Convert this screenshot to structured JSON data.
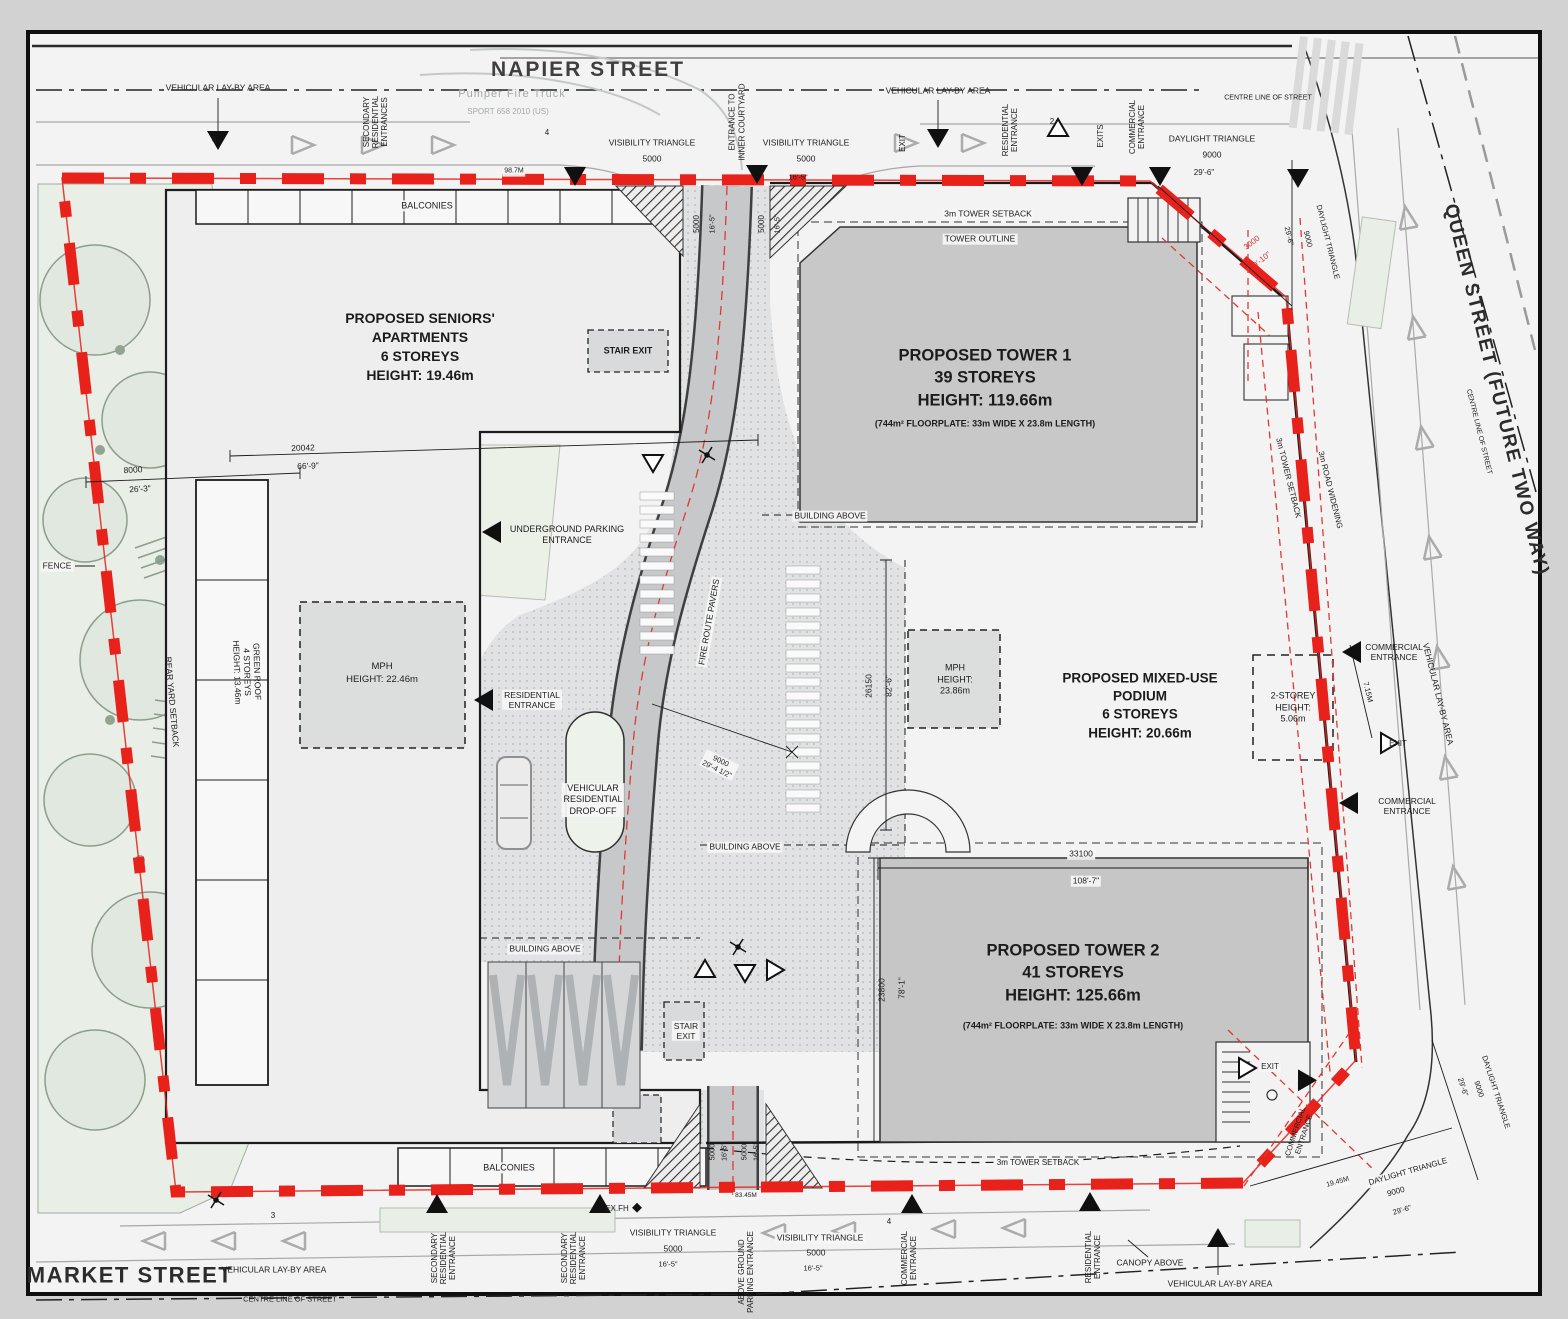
{
  "drawing_title": "Proposed mixed-use development site plan",
  "colors": {
    "boundary_red": "#e8211b",
    "tower_fill": "#c8c8c9",
    "green_area": "#e9efe6",
    "ground": "#f3f3f4",
    "line_black": "#1c1c1c"
  },
  "streets": {
    "top": "NAPIER STREET",
    "right": "QUEEN STREET (FUTURE TWO WAY)",
    "bottom": "MARKET STREET"
  },
  "annotations": [
    {
      "name": "street-label-napier",
      "t": "NAPIER STREET",
      "x": 588,
      "y": 70,
      "s": 21,
      "w": 700,
      "ls": 2,
      "c": "#3f3f3f"
    },
    {
      "name": "street-label-queen",
      "t": "QUEEN STREET (FUTURE TWO WAY)",
      "x": 1496,
      "y": 390,
      "s": 19,
      "w": 700,
      "ls": 1.5,
      "r": 76,
      "c": "#2c2c2c"
    },
    {
      "name": "street-label-market",
      "t": "MARKET STREET",
      "x": 130,
      "y": 1275,
      "s": 22,
      "w": 700,
      "ls": 1.5,
      "c": "#2c2c2c"
    },
    {
      "t": "CENTRE LINE OF STREET",
      "x": 290,
      "y": 1299,
      "s": 7.5
    },
    {
      "t": "CENTRE LINE OF STREET",
      "x": 1268,
      "y": 99,
      "s": 7
    },
    {
      "t": "CENTRE LINE OF STREET",
      "x": 1478,
      "y": 432,
      "s": 7,
      "r": 76
    },
    {
      "t": "VEHICULAR LAY-BY AREA",
      "x": 218,
      "y": 88,
      "s": 8.5
    },
    {
      "t": "SECONDARY\nRESIDENTIAL\nENTRANCES",
      "x": 376,
      "y": 122,
      "s": 8,
      "r": -90,
      "lh": 1.15
    },
    {
      "t": "Pumper Fire Truck",
      "x": 512,
      "y": 95,
      "s": 11,
      "c": "#a3aaa8",
      "ls": 1
    },
    {
      "t": "SPORT 658 2010 (US)",
      "x": 508,
      "y": 112,
      "s": 8,
      "c": "#a3aaa8"
    },
    {
      "t": "VISIBILITY TRIANGLE",
      "x": 652,
      "y": 143,
      "s": 8.5
    },
    {
      "t": "5000",
      "x": 652,
      "y": 159,
      "s": 8.5
    },
    {
      "t": "VISIBILITY TRIANGLE",
      "x": 806,
      "y": 143,
      "s": 8.5
    },
    {
      "t": "5000",
      "x": 806,
      "y": 159,
      "s": 8.5
    },
    {
      "t": "16'-5\"",
      "x": 798,
      "y": 177,
      "s": 7.5
    },
    {
      "t": "ENTRANCE TO\nINNER COURTYARD",
      "x": 737,
      "y": 122,
      "s": 8,
      "r": -90,
      "lh": 1.2
    },
    {
      "t": "VEHICULAR LAY-BY AREA",
      "x": 938,
      "y": 91,
      "s": 8.5
    },
    {
      "t": "EXIT",
      "x": 903,
      "y": 143,
      "s": 8,
      "r": -90
    },
    {
      "t": "RESIDENTIAL\nENTRANCE",
      "x": 1010,
      "y": 130,
      "s": 8,
      "r": -90,
      "lh": 1.15
    },
    {
      "t": "EXITS",
      "x": 1101,
      "y": 136,
      "s": 8,
      "r": -90
    },
    {
      "t": "COMMERCIAL\nENTRANCE",
      "x": 1137,
      "y": 127,
      "s": 8,
      "r": -90,
      "lh": 1.15
    },
    {
      "t": "DAYLIGHT TRIANGLE",
      "x": 1212,
      "y": 139,
      "s": 8.5
    },
    {
      "t": "9000",
      "x": 1212,
      "y": 155,
      "s": 8.5
    },
    {
      "t": "29'-6\"",
      "x": 1204,
      "y": 173,
      "s": 8
    },
    {
      "t": "3m TOWER SETBACK",
      "x": 988,
      "y": 214,
      "s": 8.5,
      "bg": 1
    },
    {
      "t": "TOWER OUTLINE",
      "x": 980,
      "y": 239,
      "s": 8.5,
      "bg": 1
    },
    {
      "t": "5000",
      "x": 697,
      "y": 224,
      "s": 8,
      "r": -90
    },
    {
      "t": "16'-5\"",
      "x": 712,
      "y": 224,
      "s": 7.5,
      "r": -90
    },
    {
      "t": "5000",
      "x": 762,
      "y": 224,
      "s": 8,
      "r": -90
    },
    {
      "t": "16'-5\"",
      "x": 777,
      "y": 224,
      "s": 7.5,
      "r": -90
    },
    {
      "t": "3000",
      "x": 1252,
      "y": 243,
      "s": 8,
      "r": -38,
      "c": "#d5352b"
    },
    {
      "t": "9'-10\"",
      "x": 1262,
      "y": 260,
      "s": 8,
      "r": -38,
      "c": "#d5352b"
    },
    {
      "t": "29'-6\"",
      "x": 1289,
      "y": 236,
      "s": 7.5,
      "r": 76
    },
    {
      "t": "9000",
      "x": 1308,
      "y": 239,
      "s": 7.5,
      "r": 76
    },
    {
      "t": "DAYLIGHT TRIANGLE",
      "x": 1328,
      "y": 242,
      "s": 7.5,
      "r": 76
    },
    {
      "t": "98.7M",
      "x": 514,
      "y": 172,
      "s": 7,
      "bg": 1
    },
    {
      "t": "6",
      "x": 214,
      "y": 140,
      "s": 8
    },
    {
      "t": "4",
      "x": 547,
      "y": 133,
      "s": 8
    },
    {
      "t": "2",
      "x": 1052,
      "y": 122,
      "s": 8
    },
    {
      "name": "label-seniors-apartments",
      "t": "PROPOSED SENIORS'\nAPARTMENTS\n6 STOREYS\nHEIGHT: 19.46m",
      "x": 420,
      "y": 347,
      "s": 14,
      "w": 600,
      "lh": 1.35
    },
    {
      "t": "STAIR EXIT",
      "x": 628,
      "y": 351,
      "s": 9,
      "w": 600
    },
    {
      "t": "20042",
      "x": 303,
      "y": 448,
      "s": 8.5,
      "r": -2
    },
    {
      "t": "66'-9\"",
      "x": 308,
      "y": 466,
      "s": 8.5,
      "r": -2
    },
    {
      "t": "8000",
      "x": 133,
      "y": 470,
      "s": 8.5,
      "r": -3
    },
    {
      "t": "26'-3\"",
      "x": 140,
      "y": 489,
      "s": 8.5,
      "r": -3
    },
    {
      "t": "FENCE",
      "x": 57,
      "y": 566,
      "s": 8.5,
      "bg": 1
    },
    {
      "t": "REAR YARD SETBACK",
      "x": 172,
      "y": 702,
      "s": 8.5,
      "r": 85
    },
    {
      "t": "GREEN ROOF\n4 STOREYS\nHEIGHT: 13.46m",
      "x": 247,
      "y": 672,
      "s": 8.5,
      "r": 88,
      "lh": 1.2
    },
    {
      "name": "label-mph-west",
      "t": "MPH\nHEIGHT: 22.46m",
      "x": 382,
      "y": 674,
      "s": 9.5,
      "lh": 1.35
    },
    {
      "t": "UNDERGROUND PARKING\nENTRANCE",
      "x": 567,
      "y": 535,
      "s": 9,
      "lh": 1.25
    },
    {
      "t": "RESIDENTIAL\nENTRANCE",
      "x": 532,
      "y": 700,
      "s": 8.5,
      "lh": 1.2,
      "bg": 1
    },
    {
      "t": "VEHICULAR\nRESIDENTIAL\nDROP-OFF",
      "x": 593,
      "y": 800,
      "s": 9,
      "lh": 1.25,
      "bg": 1
    },
    {
      "t": "FIRE ROUTE PAVERS",
      "x": 709,
      "y": 622,
      "s": 8.5,
      "r": -80,
      "bg": 1
    },
    {
      "t": "BUILDING ABOVE",
      "x": 830,
      "y": 516,
      "s": 8.5,
      "bg": 1
    },
    {
      "t": "BUILDING ABOVE",
      "x": 745,
      "y": 847,
      "s": 8.5,
      "bg": 1
    },
    {
      "t": "BUILDING ABOVE",
      "x": 545,
      "y": 949,
      "s": 8.5,
      "bg": 1
    },
    {
      "name": "label-tower-1",
      "t": "PROPOSED TOWER 1\n39 STOREYS\nHEIGHT: 119.66m",
      "x": 985,
      "y": 378,
      "s": 16.5,
      "w": 600,
      "lh": 1.35
    },
    {
      "name": "label-tower-1-floorplate",
      "t": "(744m² FLOORPLATE: 33m WIDE X 23.8m LENGTH)",
      "x": 985,
      "y": 424,
      "s": 9,
      "w": 700
    },
    {
      "name": "label-podium",
      "t": "PROPOSED MIXED-USE\nPODIUM\n6 STOREYS\nHEIGHT: 20.66m",
      "x": 1140,
      "y": 706,
      "s": 13.5,
      "w": 600,
      "lh": 1.35
    },
    {
      "name": "label-mph-east",
      "t": "MPH\nHEIGHT:\n23.86m",
      "x": 955,
      "y": 680,
      "s": 9,
      "lh": 1.3
    },
    {
      "t": "26150",
      "x": 869,
      "y": 686,
      "s": 8.5,
      "r": -90
    },
    {
      "t": "82'-6\"",
      "x": 889,
      "y": 686,
      "s": 8.5,
      "r": -90
    },
    {
      "name": "label-2-storey",
      "t": "2-STOREY\nHEIGHT:\n5.06m",
      "x": 1293,
      "y": 708,
      "s": 9,
      "lh": 1.3
    },
    {
      "t": "COMMERCIAL\nENTRANCE",
      "x": 1394,
      "y": 652,
      "s": 8.5,
      "lh": 1.2
    },
    {
      "t": "7.15M",
      "x": 1368,
      "y": 692,
      "s": 7.5,
      "r": 76
    },
    {
      "t": "EXIT",
      "x": 1398,
      "y": 744,
      "s": 8
    },
    {
      "t": "COMMERCIAL\nENTRANCE",
      "x": 1407,
      "y": 806,
      "s": 8.5,
      "lh": 1.2
    },
    {
      "t": "3m TOWER SETBACK",
      "x": 1288,
      "y": 478,
      "s": 8,
      "r": 76
    },
    {
      "t": "3m ROAD WIDENING",
      "x": 1330,
      "y": 490,
      "s": 8,
      "r": 76
    },
    {
      "t": "VEHICULAR LAY-BY AREA",
      "x": 1438,
      "y": 694,
      "s": 8.5,
      "r": 76
    },
    {
      "t": "9000\n29'-4 1/2\"",
      "x": 719,
      "y": 765,
      "s": 7.5,
      "r": 26,
      "lh": 1.2,
      "bg": 1
    },
    {
      "t": "33100",
      "x": 1081,
      "y": 854,
      "s": 8.5,
      "bg": 1
    },
    {
      "t": "108'-7\"",
      "x": 1086,
      "y": 881,
      "s": 8.5,
      "bg": 1
    },
    {
      "t": "23800",
      "x": 882,
      "y": 990,
      "s": 8.5,
      "r": -90
    },
    {
      "t": "78'-1\"",
      "x": 902,
      "y": 988,
      "s": 8.5,
      "r": -90
    },
    {
      "name": "label-tower-2",
      "t": "PROPOSED TOWER 2\n41 STOREYS\nHEIGHT: 125.66m",
      "x": 1073,
      "y": 973,
      "s": 16.5,
      "w": 600,
      "lh": 1.35
    },
    {
      "name": "label-tower-2-floorplate",
      "t": "(744m² FLOORPLATE: 33m WIDE X 23.8m LENGTH)",
      "x": 1073,
      "y": 1026,
      "s": 9,
      "w": 700
    },
    {
      "t": "STAIR\nEXIT",
      "x": 686,
      "y": 1031,
      "s": 8.5,
      "lh": 1.2,
      "bg": 1
    },
    {
      "t": "EXIT",
      "x": 1270,
      "y": 1067,
      "s": 8,
      "bg": 1
    },
    {
      "t": "COMMERCIAL\nENTRANCE",
      "x": 1300,
      "y": 1133,
      "s": 7.5,
      "r": -72,
      "lh": 1.15
    },
    {
      "t": "3m TOWER SETBACK",
      "x": 1038,
      "y": 1163,
      "s": 8,
      "bg": 1
    },
    {
      "t": "83.45M",
      "x": 746,
      "y": 1196,
      "s": 6.5,
      "bg": 1
    },
    {
      "t": "EX.FH",
      "x": 617,
      "y": 1209,
      "s": 8
    },
    {
      "t": "VISIBILITY TRIANGLE",
      "x": 673,
      "y": 1233,
      "s": 8.5,
      "bg": 1
    },
    {
      "t": "5000",
      "x": 673,
      "y": 1249,
      "s": 8.5
    },
    {
      "t": "16'-5\"",
      "x": 668,
      "y": 1264,
      "s": 7.5
    },
    {
      "t": "VISIBILITY TRIANGLE",
      "x": 820,
      "y": 1238,
      "s": 8.5,
      "bg": 1
    },
    {
      "t": "5000",
      "x": 816,
      "y": 1253,
      "s": 8.5
    },
    {
      "t": "16'-5\"",
      "x": 813,
      "y": 1268,
      "s": 7.5
    },
    {
      "t": "5000",
      "x": 712,
      "y": 1152,
      "s": 7.5,
      "r": -90
    },
    {
      "t": "16'-5\"",
      "x": 726,
      "y": 1152,
      "s": 7,
      "r": -90
    },
    {
      "t": "5000",
      "x": 744,
      "y": 1152,
      "s": 7.5,
      "r": -90
    },
    {
      "t": "16'-5\"",
      "x": 758,
      "y": 1152,
      "s": 7,
      "r": -90
    },
    {
      "t": "SECONDARY\nRESIDENTIAL\nENTRANCE",
      "x": 444,
      "y": 1258,
      "s": 8,
      "r": -90,
      "lh": 1.15
    },
    {
      "t": "SECONDARY\nRESIDENTIAL\nENTRANCE",
      "x": 574,
      "y": 1258,
      "s": 8,
      "r": -90,
      "lh": 1.15
    },
    {
      "t": "ABOVE GROUND\nPARKING ENTRANCE",
      "x": 746,
      "y": 1272,
      "s": 8,
      "r": -90,
      "lh": 1.15
    },
    {
      "t": "COMMERCIAL\nENTRANCE",
      "x": 909,
      "y": 1258,
      "s": 8,
      "r": -90,
      "lh": 1.15
    },
    {
      "t": "RESIDENTIAL\nENTRANCE",
      "x": 1093,
      "y": 1257,
      "s": 8,
      "r": -90,
      "lh": 1.15
    },
    {
      "t": "CANOPY ABOVE",
      "x": 1150,
      "y": 1263,
      "s": 8.5
    },
    {
      "t": "VEHICULAR LAY-BY AREA",
      "x": 1220,
      "y": 1284,
      "s": 8.5
    },
    {
      "t": "VEHICULAR LAY-BY AREA",
      "x": 274,
      "y": 1270,
      "s": 8.5
    },
    {
      "t": "BALCONIES",
      "x": 427,
      "y": 206,
      "s": 9,
      "bg": 1
    },
    {
      "t": "BALCONIES",
      "x": 509,
      "y": 1168,
      "s": 9,
      "bg": 1
    },
    {
      "t": "19.45M",
      "x": 1338,
      "y": 1183,
      "s": 7,
      "r": -16,
      "bg": 1
    },
    {
      "t": "DAYLIGHT TRIANGLE",
      "x": 1408,
      "y": 1172,
      "s": 8,
      "r": -16,
      "bg": 1
    },
    {
      "t": "9000",
      "x": 1396,
      "y": 1192,
      "s": 8,
      "r": -16
    },
    {
      "t": "29'-6\"",
      "x": 1402,
      "y": 1210,
      "s": 7.5,
      "r": -16
    },
    {
      "t": "29'-6\"",
      "x": 1463,
      "y": 1087,
      "s": 7.5,
      "r": 72
    },
    {
      "t": "9000",
      "x": 1479,
      "y": 1089,
      "s": 7.5,
      "r": 72
    },
    {
      "t": "DAYLIGHT TRIANGLE",
      "x": 1496,
      "y": 1092,
      "s": 7.5,
      "r": 72
    },
    {
      "t": "3",
      "x": 273,
      "y": 1216,
      "s": 8
    },
    {
      "t": "4",
      "x": 889,
      "y": 1222,
      "s": 8
    }
  ]
}
